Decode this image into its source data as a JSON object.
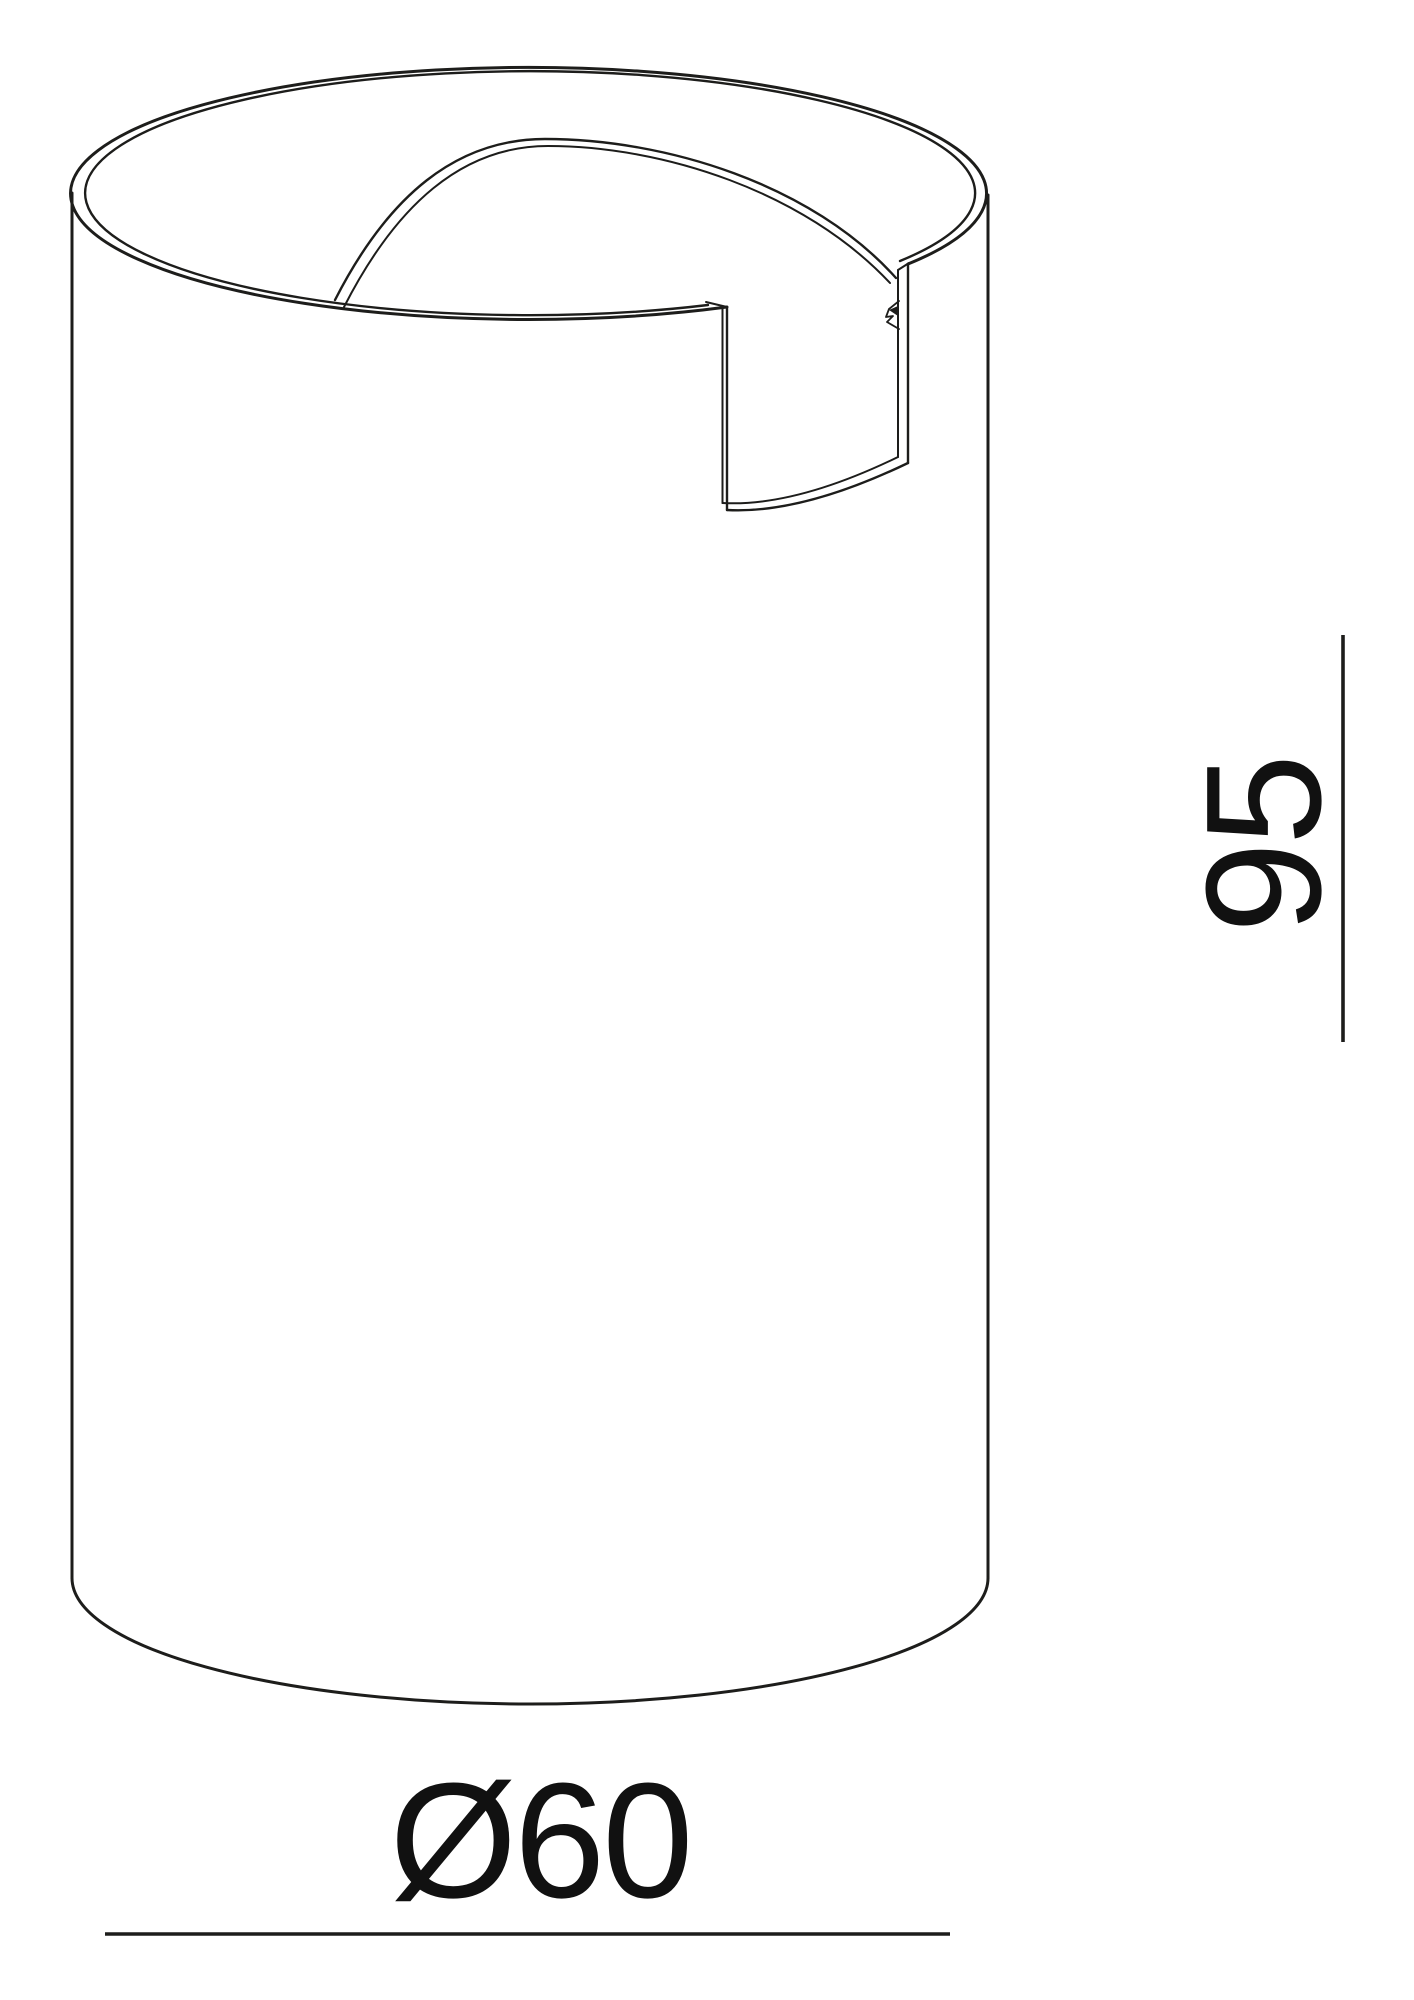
{
  "drawing": {
    "description": "Monochrome CAD-style isometric line drawing of a hollow cylindrical housing with a rectangular notch cut down from the top rim and a small clip tab on the notch edge",
    "background_color": "#ffffff",
    "line_color": "#1d1d1b",
    "text_color": "#111111",
    "dimensions": {
      "diameter": {
        "label": "Ø60",
        "value": "60"
      },
      "height": {
        "label": "95",
        "value": "95"
      }
    }
  }
}
